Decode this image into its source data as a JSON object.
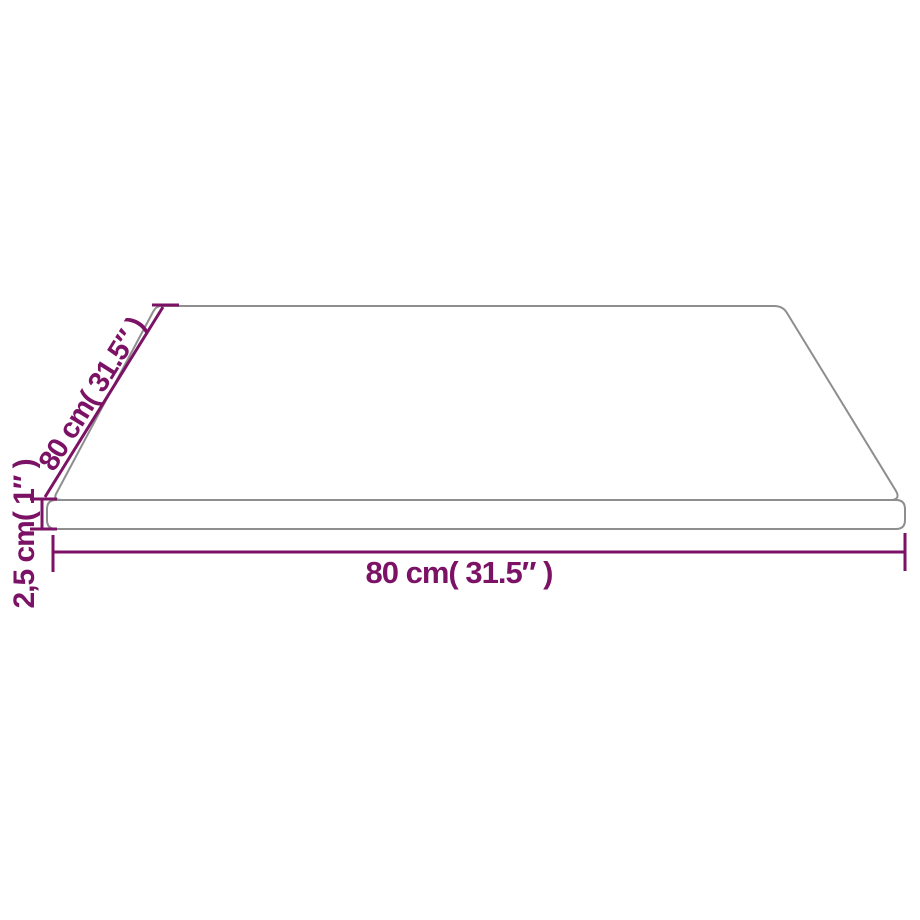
{
  "diagram": {
    "kind": "product-dimension-diagram",
    "subject": "square-table-top-perspective-view",
    "labels": {
      "depth": "80 cm( 31.5″ )",
      "thickness": "2,5 cm( 1″ )",
      "width": "80 cm( 31.5″ )"
    },
    "colors": {
      "dimension_accent": "#7b1265",
      "panel_outline": "#8e8e8e",
      "panel_fill": "#ffffff",
      "background": "#ffffff"
    }
  }
}
